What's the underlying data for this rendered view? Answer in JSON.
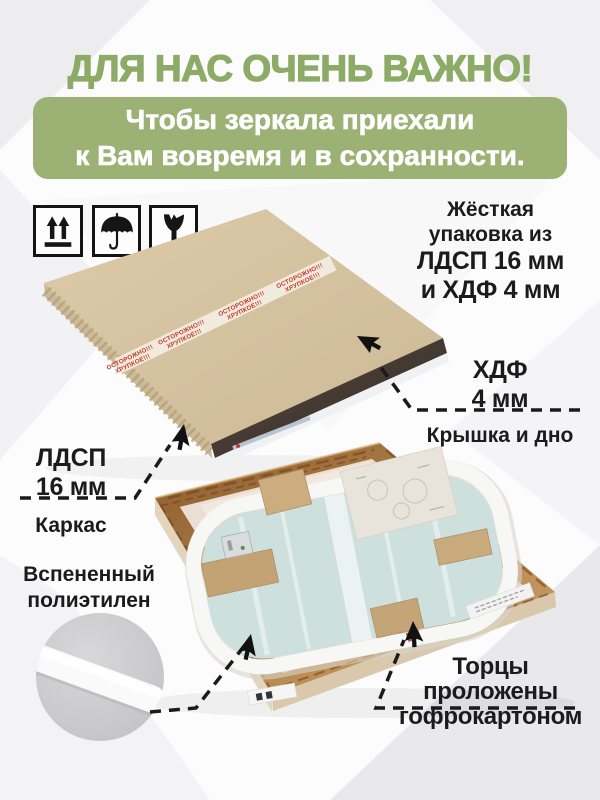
{
  "colors": {
    "title_green": "#8cab66",
    "banner_green": "#9cb274",
    "tape_red": "#c5382d",
    "label_black": "#1b1b1b"
  },
  "header": {
    "title": "ДЛЯ НАС ОЧЕНЬ ВАЖНО!",
    "banner_line1": "Чтобы зеркала приехали",
    "banner_line2": "к Вам вовремя и в сохранности."
  },
  "handling_icons": [
    {
      "name": "this-side-up"
    },
    {
      "name": "keep-dry-umbrella"
    },
    {
      "name": "fragile-glass"
    }
  ],
  "tape": {
    "line1": "ОСТОРОЖНО!!!",
    "line2": "ХРУПКОЕ!!!"
  },
  "annotations": {
    "rigid": {
      "line1": "Жёсткая",
      "line2": "упаковка из",
      "line3": "ЛДСП 16 мм",
      "line4": "и ХДФ 4 мм"
    },
    "hdf": {
      "line1": "ХДФ",
      "line2": "4 мм",
      "caption": "Крышка и дно"
    },
    "ldsp": {
      "line1": "ЛДСП",
      "line2": "16 мм",
      "caption": "Каркас"
    },
    "foam": {
      "line1": "Вспененный",
      "line2": "полиэтилен"
    },
    "edges": {
      "line1": "Торцы",
      "line2": "проложены",
      "line3": "гофрокартоном"
    }
  }
}
